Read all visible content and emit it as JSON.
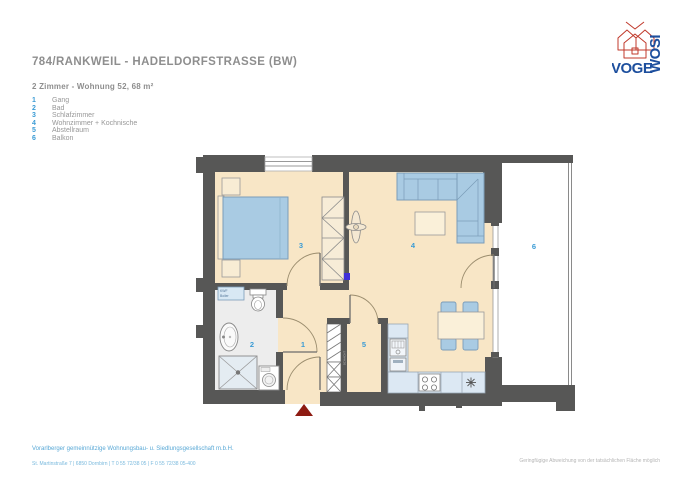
{
  "header": {
    "title": "784/RANKWEIL - HADELDORFSTRASSE (BW)",
    "subtitle": "2 Zimmer - Wohnung  52, 68 m²"
  },
  "legend": {
    "items": [
      {
        "number": "1",
        "label": "Gang"
      },
      {
        "number": "2",
        "label": "Bad"
      },
      {
        "number": "3",
        "label": "Schlafzimmer"
      },
      {
        "number": "4",
        "label": "Wohnzimmer + Kochnische"
      },
      {
        "number": "5",
        "label": "Abstellraum"
      },
      {
        "number": "6",
        "label": "Balkon"
      }
    ]
  },
  "plan": {
    "room_numbers": {
      "gang": "1",
      "bad": "2",
      "schlafzimmer": "3",
      "wohnzimmer": "4",
      "abstellraum": "5",
      "balkon": "6"
    },
    "shaft_label": "SCHACHT",
    "boiler_label_line1": "KWF",
    "boiler_label_line2": "Boiler",
    "colors": {
      "floor": "#f8e6c6",
      "bath_floor": "#ededed",
      "wall": "#575756",
      "furniture_blue": "#a9cbe3",
      "kitchen_counter": "#dce8f3",
      "cream_furniture": "#faf0d9",
      "room_label_blue": "#3a9bd5",
      "entrance_marker_red": "#8e1b12"
    }
  },
  "logo": {
    "text_horizontal": "VOGE",
    "text_vertical": "WOSI",
    "brand_blue": "#1d4f9e",
    "brand_red": "#c0392b"
  },
  "footer": {
    "company": "Vorarlberger gemeinnützige Wohnungsbau- u. Siedlungsgesellschaft m.b.H.",
    "address": "St. Martinstraße 7   |   6850 Dornbirn   |   T 0 55 72/38 05   |   F 0 55 72/38 05-400",
    "disclaimer": "Geringfügige Abweichung von der tatsächlichen Fläche möglich"
  }
}
